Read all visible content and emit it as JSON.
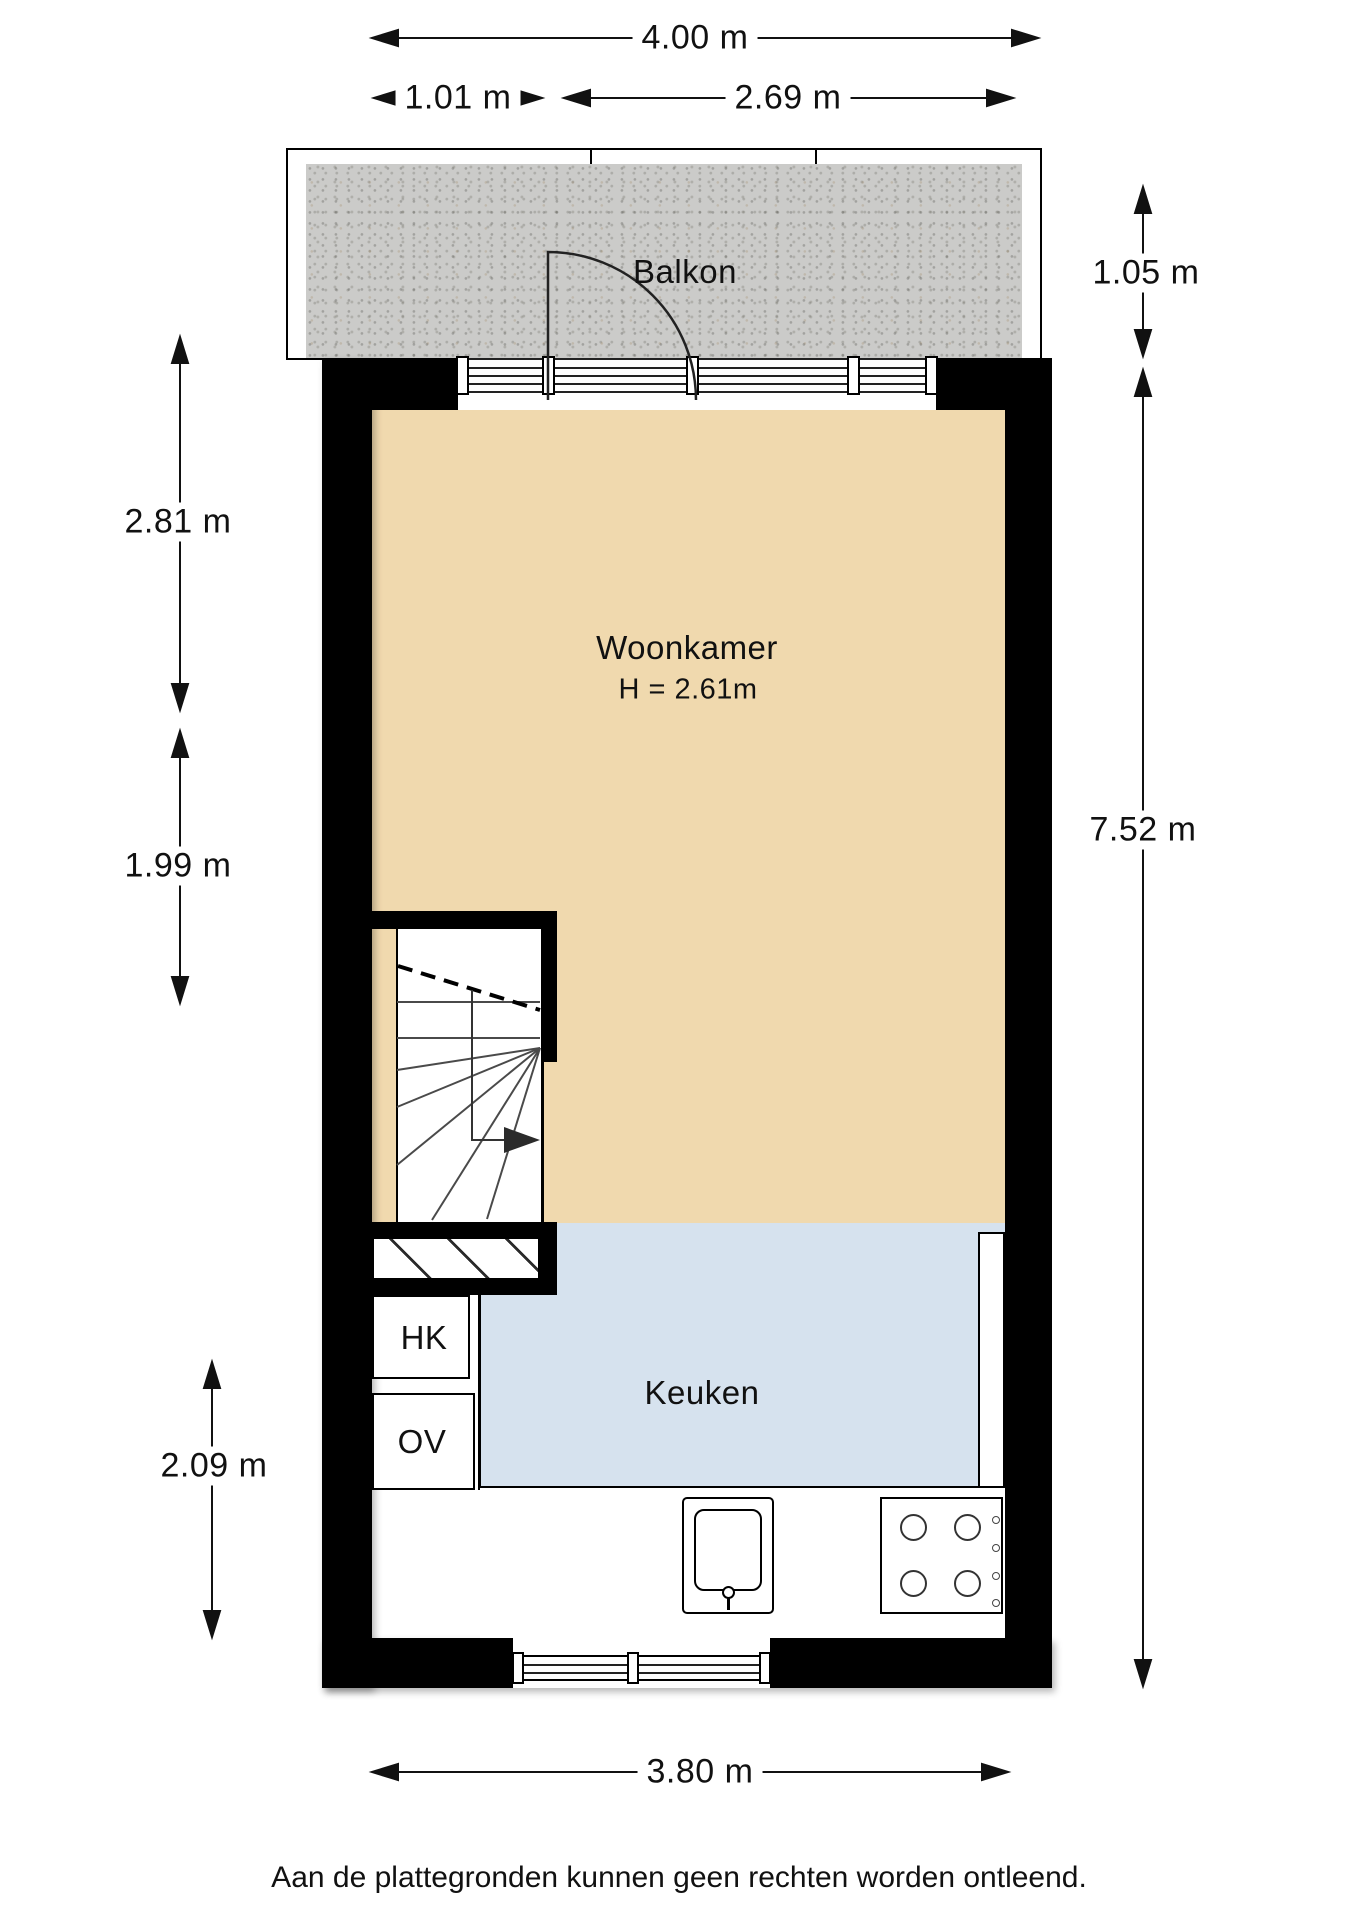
{
  "rooms": {
    "balcony": "Balkon",
    "living": "Woonkamer",
    "living_height": "H = 2.61m",
    "kitchen": "Keuken",
    "closet_hk": "HK",
    "closet_ov": "OV"
  },
  "dimensions": {
    "top_total": "4.00 m",
    "top_left": "1.01 m",
    "top_right": "2.69 m",
    "balcony_depth": "1.05 m",
    "left_upper": "2.81 m",
    "left_middle": "1.99 m",
    "left_lower": "2.09 m",
    "right_total": "7.52 m",
    "bottom": "3.80 m"
  },
  "footer": {
    "disclaimer": "Aan de plattegronden kunnen geen rechten worden ontleend."
  },
  "colors": {
    "wall": "#000000",
    "living_floor": "#f0d9ae",
    "kitchen_floor": "#d6e2ee",
    "balcony_floor": "#cbcbc9",
    "line": "#1a1a1a"
  }
}
